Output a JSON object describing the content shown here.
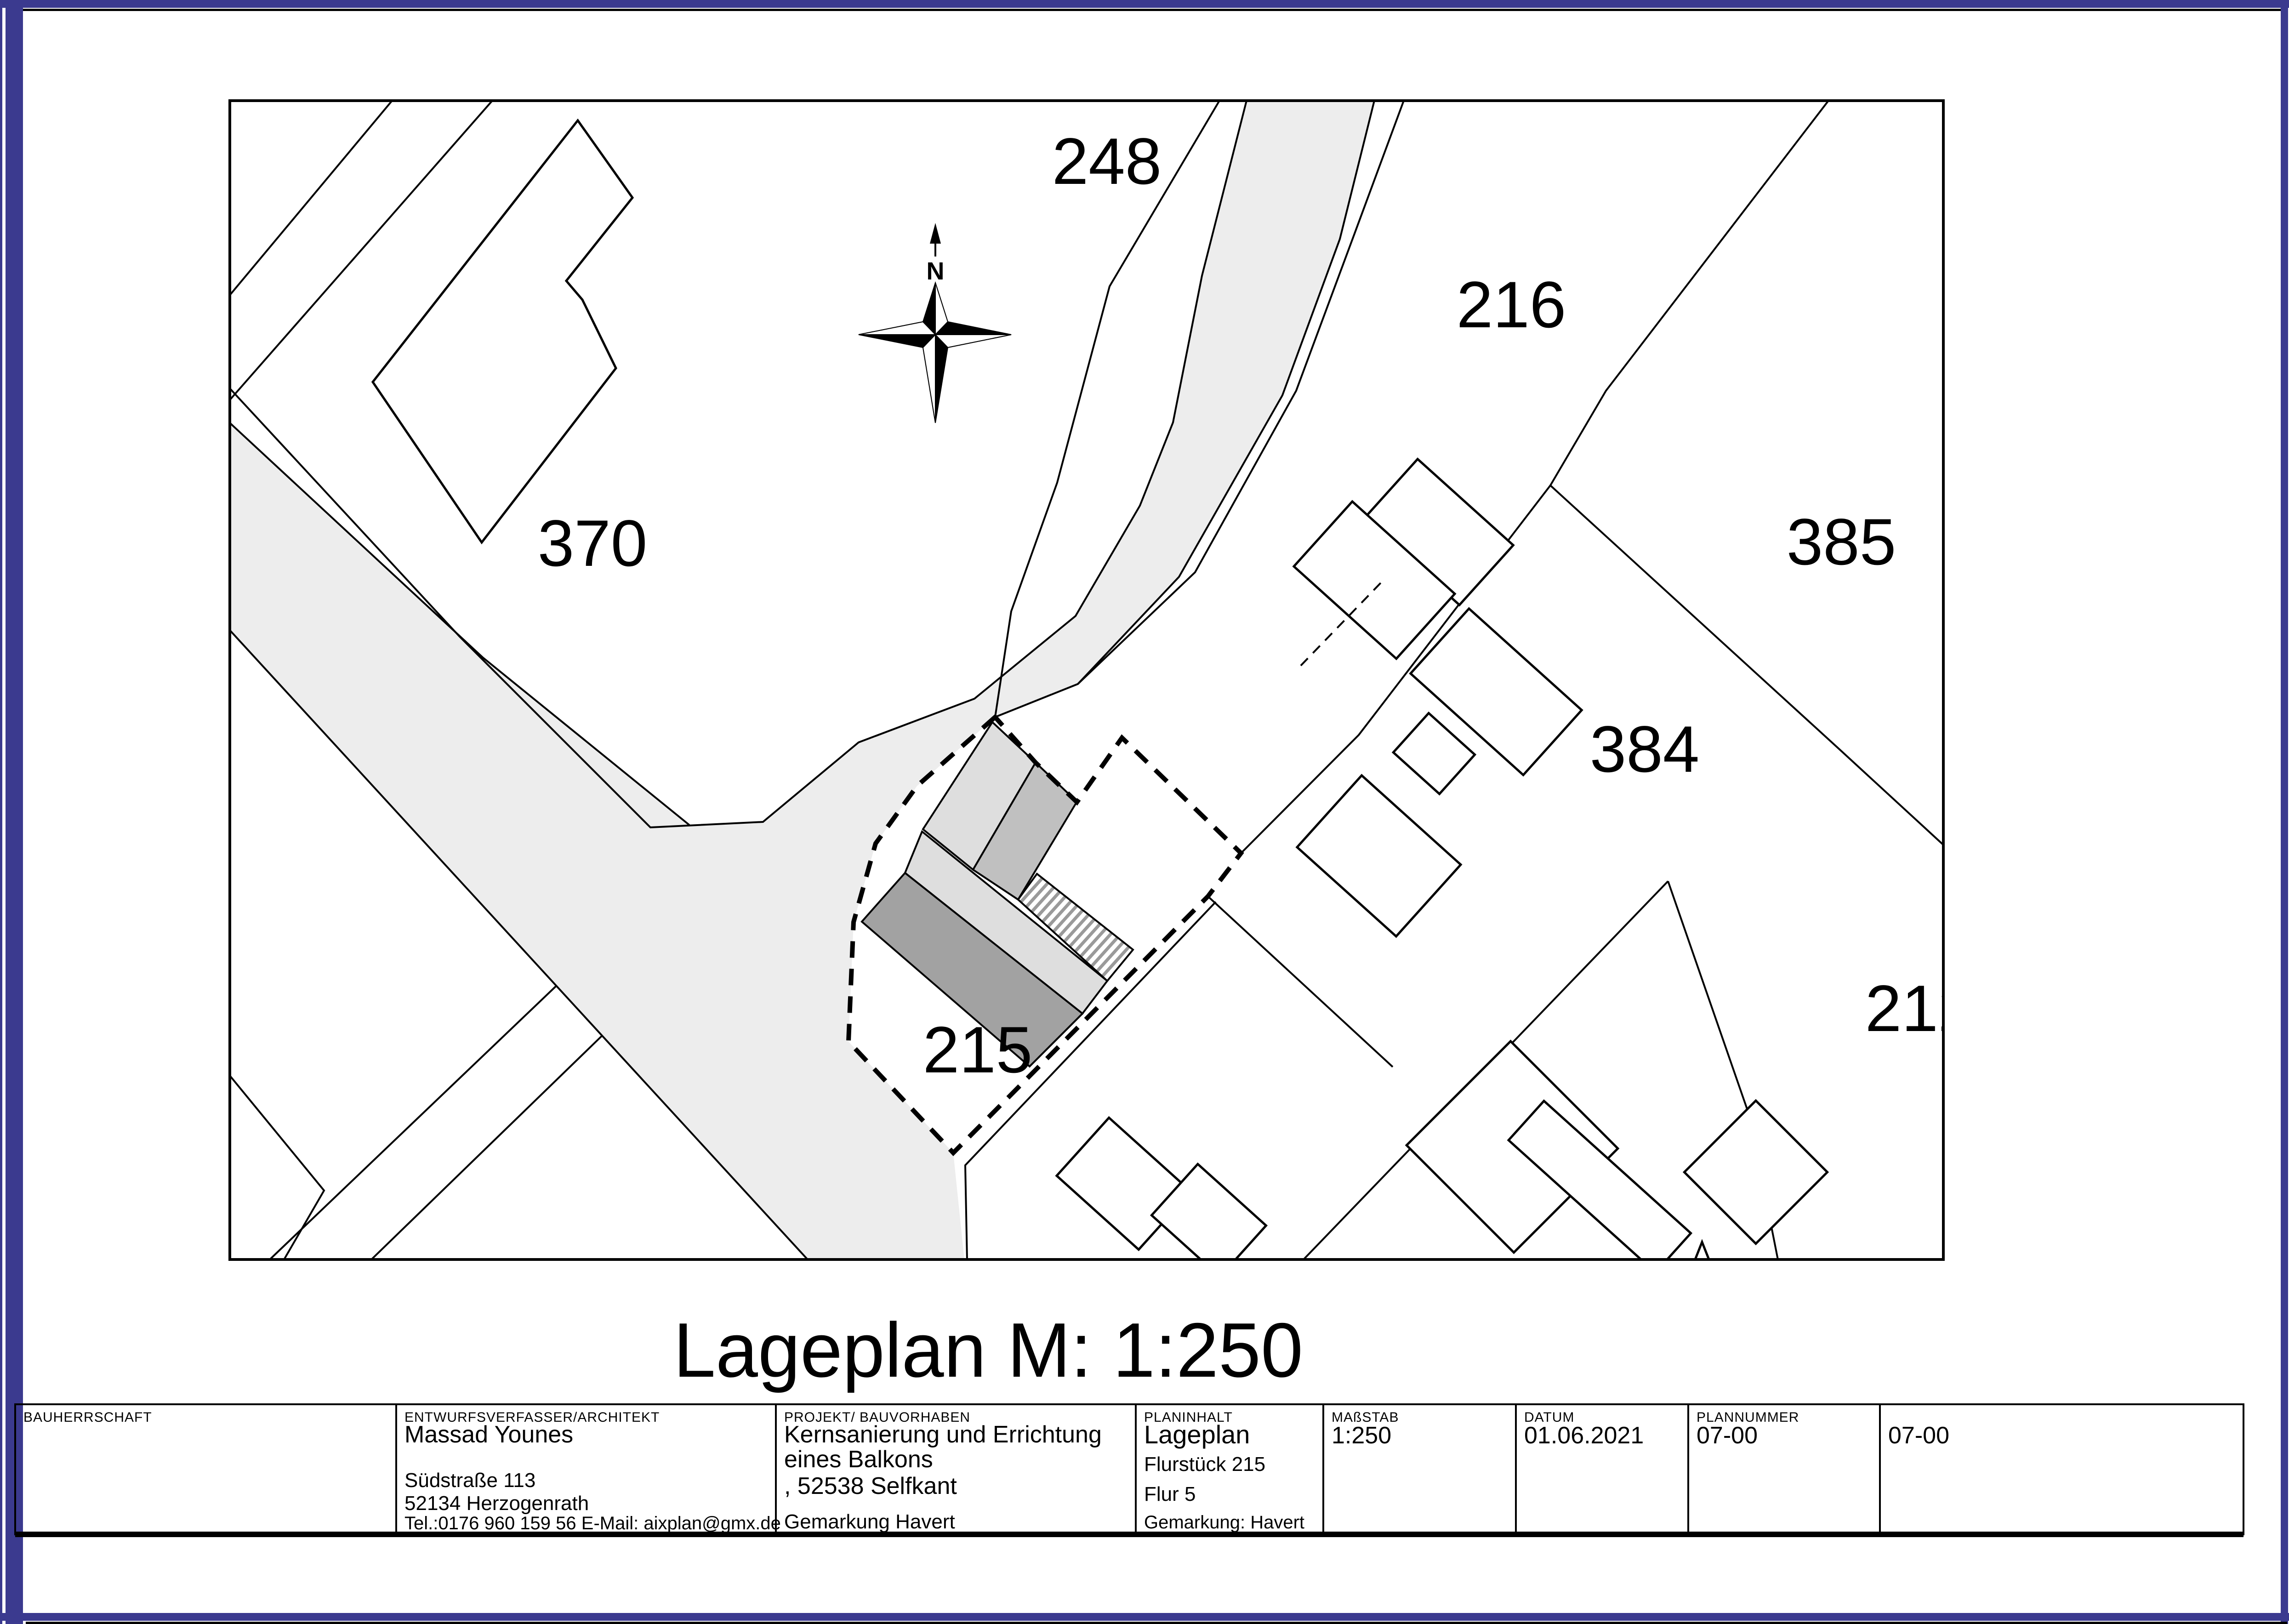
{
  "page": {
    "border_color": "#3b3a8f"
  },
  "colors": {
    "road": "#ededed",
    "band_light": "#dedede",
    "band_mid": "#c0c0c0",
    "band_dark": "#a2a2a2",
    "hatch_stripe": "#9a9a9a"
  },
  "map": {
    "title": "Lageplan M: 1:250",
    "north_label": "N",
    "parcels": [
      {
        "label": "248"
      },
      {
        "label": "216"
      },
      {
        "label": "370"
      },
      {
        "label": "385"
      },
      {
        "label": "384"
      },
      {
        "label": "212"
      },
      {
        "label": "215"
      }
    ]
  },
  "title_block": {
    "fields": [
      {
        "label": "BAUHERRSCHAFT",
        "lines": []
      },
      {
        "label": "ENTWURFSVERFASSER/ARCHITEKT",
        "lines": [
          "Massad Younes",
          "Südstraße 113",
          "52134 Herzogenrath",
          "Tel.:0176 960 159 56   E-Mail: aixplan@gmx.de"
        ]
      },
      {
        "label": "PROJEKT/ BAUVORHABEN",
        "lines": [
          "Kernsanierung und Errichtung",
          "eines Balkons",
          ", 52538 Selfkant",
          "Gemarkung Havert"
        ]
      },
      {
        "label": "PLANINHALT",
        "lines": [
          "Lageplan",
          "Flurstück 215",
          "Flur 5",
          "Gemarkung: Havert"
        ]
      },
      {
        "label": "MAßSTAB",
        "lines": [
          "1:250"
        ]
      },
      {
        "label": "DATUM",
        "lines": [
          "01.06.2021"
        ]
      },
      {
        "label": "PLANNUMMER",
        "lines": [
          "07-00"
        ]
      },
      {
        "label": "",
        "lines": [
          "07-00"
        ]
      }
    ]
  }
}
